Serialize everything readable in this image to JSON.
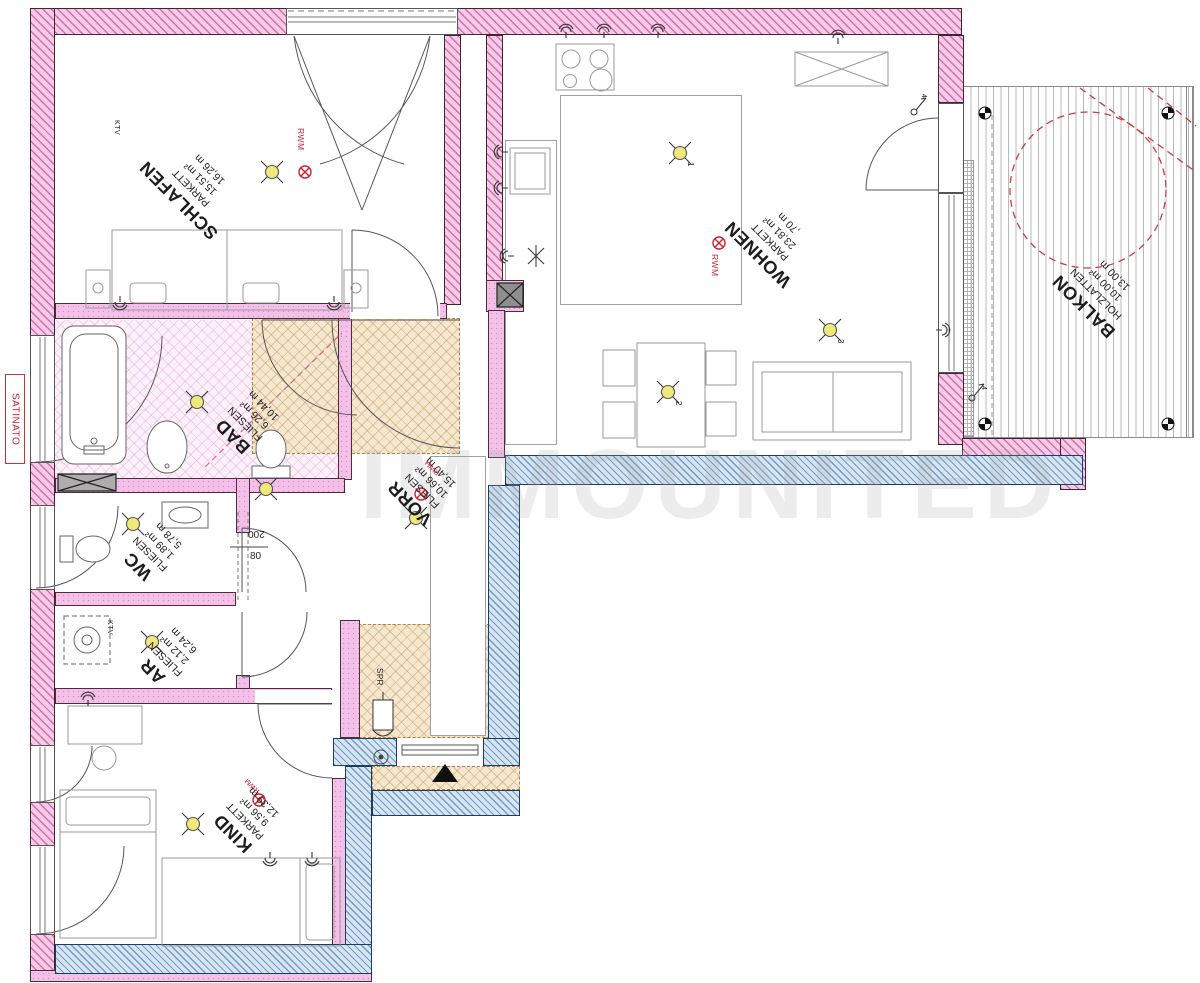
{
  "plan": {
    "watermark": "IMMOUNITED",
    "rooms": {
      "schlafen": {
        "name": "SCHLAFEN",
        "floor": "PARKETT",
        "area": "15,51 m²",
        "perimeter": "16,26 m"
      },
      "wohnen": {
        "name": "WOHNEN",
        "floor": "PARKETT",
        "area": "23,81 m²",
        "perimeter": ",70 m"
      },
      "balkon": {
        "name": "BALKON",
        "floor": "HOLZLATTEN",
        "area": "10,00 m²",
        "perimeter": "13,00 m"
      },
      "bad": {
        "name": "BAD",
        "floor": "FLIESEN",
        "area": "6,26 m²",
        "perimeter": "10,44 m"
      },
      "vorr": {
        "name": "VORR",
        "floor": "FLIESEN",
        "area": "10,66 m²",
        "perimeter": "15,40 m"
      },
      "wc": {
        "name": "WC",
        "floor": "FLIESEN",
        "area": "1,89 m²",
        "perimeter": "5,78 m"
      },
      "ar": {
        "name": "AR",
        "floor": "FLIESEN",
        "area": "2,12 m²",
        "perimeter": "6,24 m"
      },
      "kind": {
        "name": "KIND",
        "floor": "PARKETT",
        "area": "9,56 m²",
        "perimeter": "12,39 m"
      }
    },
    "annotations": {
      "satinato": "SATINATO",
      "rwm": "RWM",
      "ktv": "KTV",
      "spr": "SPR",
      "dim_width": "80",
      "dim_height": "200",
      "light_1": "1",
      "light_2": "2",
      "light_3": "3",
      "switch_4": "4"
    },
    "colors": {
      "wall_pink": "#f7c9ee",
      "hatch_red": "#ba3e5a",
      "wall_blue": "#d4e6f4",
      "hatch_blue": "#325a91",
      "corridor_beige": "#f6e7cf",
      "bad_floor_pink": "#fdf1fa",
      "light_yellow": "#efe97b",
      "marker_red": "#cf2030",
      "dashed_red": "#cf3a3a"
    }
  }
}
